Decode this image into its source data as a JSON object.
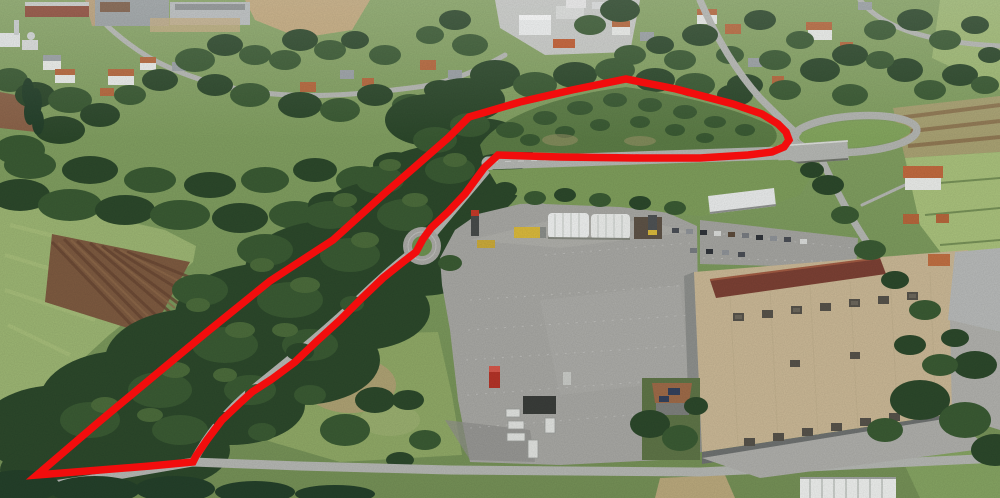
{
  "scene": {
    "type": "aerial-3d-satellite-view",
    "annotation": {
      "label": "red-area-outline",
      "shape": "freehand-closed-polygon",
      "color": "#f20d0d",
      "stroke_width": 7.5,
      "points": [
        [
          37,
          475
        ],
        [
          100,
          421
        ],
        [
          160,
          371
        ],
        [
          207,
          332
        ],
        [
          270,
          281
        ],
        [
          333,
          240
        ],
        [
          385,
          193
        ],
        [
          416,
          166
        ],
        [
          448,
          138
        ],
        [
          469,
          117
        ],
        [
          520,
          102
        ],
        [
          572,
          90
        ],
        [
          626,
          79
        ],
        [
          676,
          89
        ],
        [
          733,
          104
        ],
        [
          762,
          114
        ],
        [
          778,
          124
        ],
        [
          786,
          132
        ],
        [
          789,
          140
        ],
        [
          784,
          147
        ],
        [
          772,
          152
        ],
        [
          748,
          155
        ],
        [
          700,
          158
        ],
        [
          640,
          158
        ],
        [
          560,
          157
        ],
        [
          498,
          155
        ],
        [
          484,
          168
        ],
        [
          465,
          194
        ],
        [
          448,
          212
        ],
        [
          431,
          228
        ],
        [
          423,
          239
        ],
        [
          416,
          252
        ],
        [
          403,
          262
        ],
        [
          383,
          278
        ],
        [
          362,
          298
        ],
        [
          340,
          320
        ],
        [
          317,
          341
        ],
        [
          295,
          362
        ],
        [
          272,
          379
        ],
        [
          252,
          392
        ],
        [
          240,
          403
        ],
        [
          222,
          420
        ],
        [
          207,
          440
        ],
        [
          196,
          456
        ],
        [
          193,
          462
        ],
        [
          150,
          466
        ],
        [
          100,
          470
        ]
      ]
    },
    "palette": {
      "annotation_red": "#f20d0d",
      "forest_dark": "#2c482b",
      "forest_mid": "#3a5a33",
      "forest_light": "#4b6b3b",
      "meadow_green": "#9cb573",
      "field_brown": "#7d5a40",
      "scrub_green": "#5c7c46",
      "asphalt_gray": "#a7a7a3",
      "road_gray": "#b4b6b2",
      "factory_roof_beige": "#c9b795",
      "factory_roof_brown": "#7b4034",
      "warehouse_white": "#edefee",
      "house_roof_orange": "#b5673c",
      "loop_infield_green": "#84a65e"
    }
  }
}
